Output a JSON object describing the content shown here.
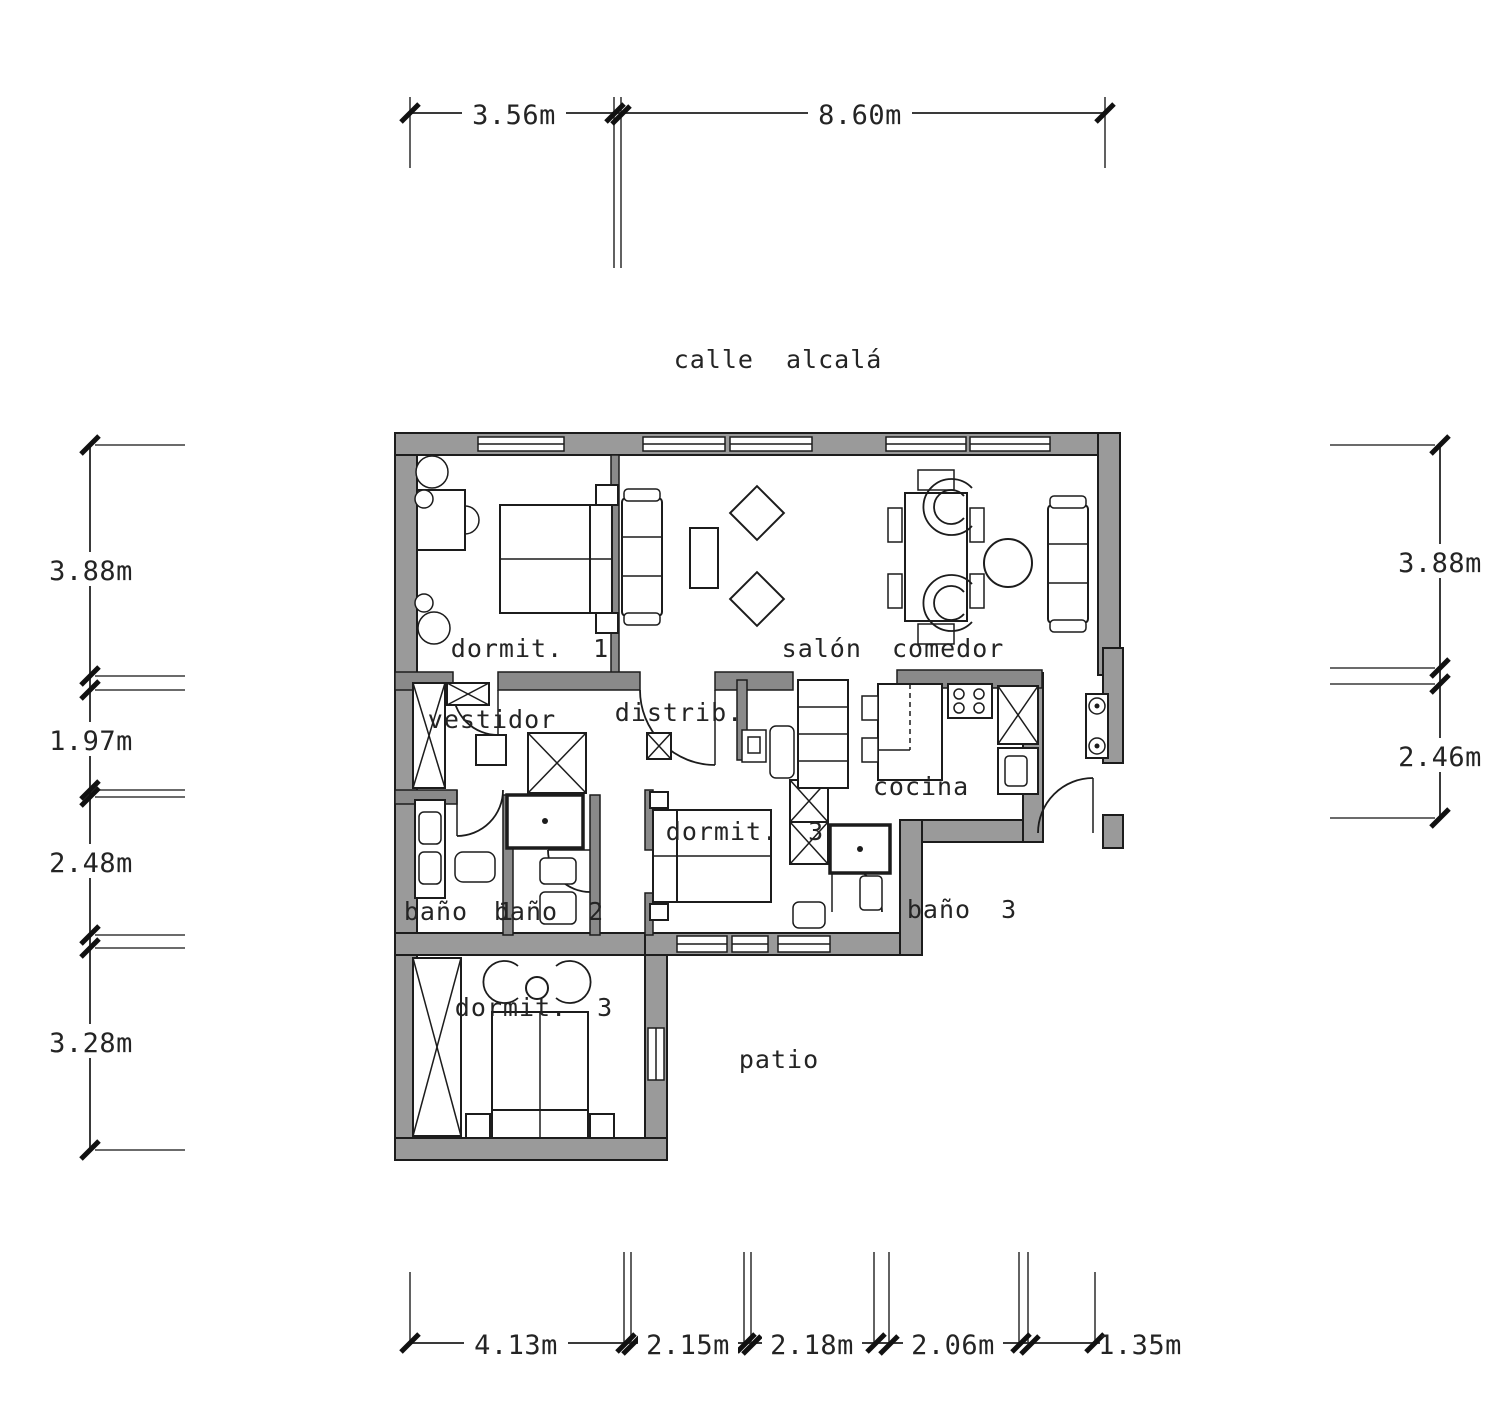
{
  "street_label": "calle alcalá",
  "rooms": {
    "dormit1": "dormit. 1",
    "salon": "salón comedor",
    "vestidor": "vestidor",
    "distrib": "distrib.",
    "dormit3_mid": "dormit. 3",
    "cocina": "cocina",
    "bano1": "baño 1",
    "bano2": "baño 2",
    "bano3": "baño 3",
    "dormit3_bottom": "dormit. 3",
    "patio": "patio"
  },
  "dimensions": {
    "top": [
      "3.56m",
      "8.60m"
    ],
    "left": [
      "3.88m",
      "1.97m",
      "2.48m",
      "3.28m"
    ],
    "right": [
      "3.88m",
      "2.46m"
    ],
    "bottom": [
      "4.13m",
      "2.15m",
      "2.18m",
      "2.06m",
      "1.35m"
    ]
  },
  "colors": {
    "wall_fill": "#9a9a9a",
    "line": "#1c1c1c",
    "text": "#242424",
    "background": "#ffffff"
  }
}
